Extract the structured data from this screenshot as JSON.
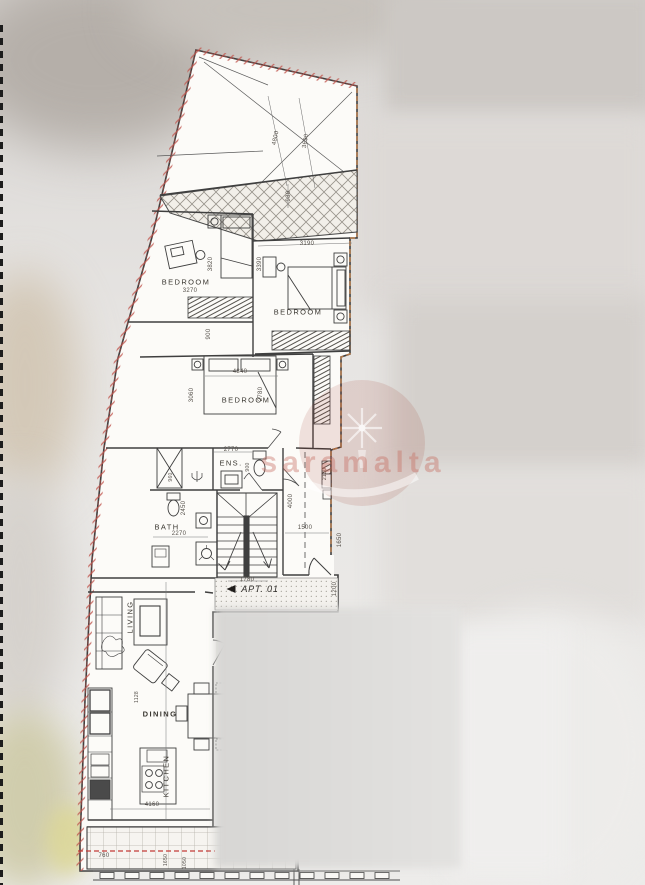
{
  "watermark": {
    "text": "saramalta",
    "color": "#c56c5e"
  },
  "plan": {
    "apartment": {
      "label": "APT. 01"
    },
    "rooms": {
      "bedroom_1": "BEDROOM",
      "bedroom_2": "BEDROOM",
      "bedroom_3": "BEDROOM",
      "ensuite": "ENS.",
      "bathroom": "BATH",
      "living": "LIVING",
      "dining": "DINING",
      "kitchen": "KITCHEN"
    },
    "dims": {
      "d4800": "4800",
      "d3690": "3690",
      "d980": "980",
      "d3270": "3270",
      "d3820": "3820",
      "d900a": "900",
      "d3190": "3190",
      "d3390": "3390",
      "d4840": "4840",
      "d3060": "3060",
      "d2780": "2780",
      "d2770": "2770",
      "d900b": "900",
      "d960": "960",
      "d2270": "2270",
      "d2450": "2450",
      "d4000": "4000",
      "d1500": "1500",
      "d2130": "2130",
      "d1780": "1780",
      "d1650a": "1650",
      "d1200": "1200",
      "d1128": "1128",
      "d4160": "4160",
      "d760": "760",
      "d1650b": "1650",
      "d1050": "1050"
    }
  }
}
